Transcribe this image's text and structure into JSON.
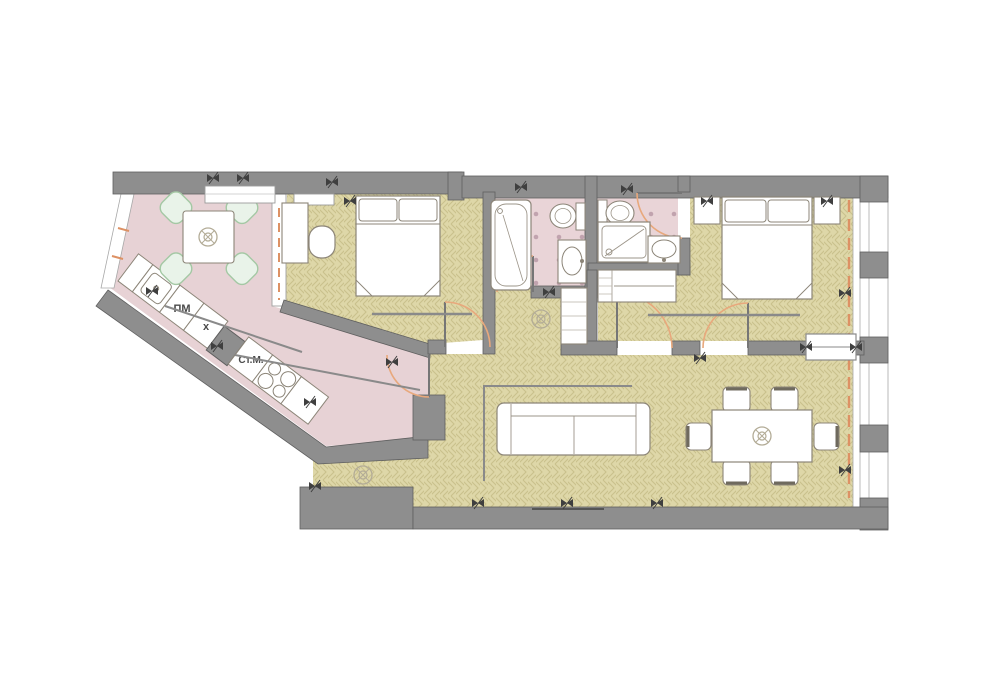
{
  "plan": {
    "title": "apartment-floor-plan",
    "labels": {
      "dishwasher": "ПМ",
      "hob": "x",
      "washing_machine": "Ст.М."
    },
    "colors": {
      "wall": "#8e8e8e",
      "wall_edge": "#5f5f5f",
      "floor_wood": "#ded7a8",
      "floor_wood_line": "#c9c18c",
      "floor_pink": "#e7d2d5",
      "bath_tile_dot": "#b493a0",
      "window_accent": "#dd9164",
      "door_arc": "#e8a87c",
      "furniture_outline": "#8c8578",
      "chair_mint_fill": "#e9f3e9",
      "chair_mint_border": "#a4c8a4"
    },
    "rooms": [
      "kitchen-dining",
      "hallway",
      "bedroom-1",
      "bathroom-1",
      "bathroom-2",
      "wardrobe-nook",
      "bedroom-2",
      "living-room",
      "entry-lobby"
    ],
    "fixtures": [
      "kitchen-counter",
      "kitchen-sink",
      "dishwasher",
      "hob",
      "washing-machine",
      "stove-4-burners",
      "dining-table-with-4-chairs",
      "dining-table-with-6-chairs",
      "sofa",
      "double-bed",
      "nightstand",
      "desk",
      "desk-chair",
      "wardrobe",
      "closet-cabinet",
      "bathtub",
      "toilet",
      "shower-cabin",
      "washbasin",
      "sliding-door",
      "hinged-door",
      "window-band",
      "socket-symbol",
      "ceiling-lamp-symbol"
    ]
  }
}
